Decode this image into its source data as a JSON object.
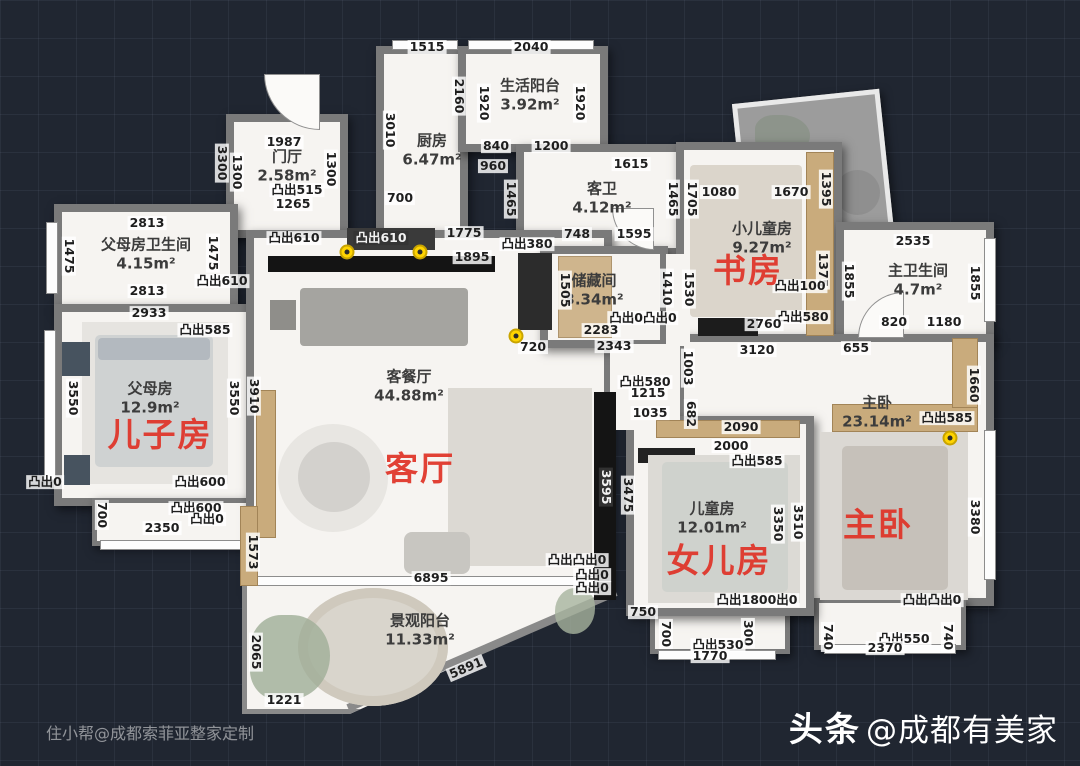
{
  "watermarks": {
    "bottom_left": "住小帮@成都索菲亚整家定制",
    "bottom_right_bold": "头条",
    "bottom_right_rest": "@成都有美家"
  },
  "colors": {
    "background": "#202631",
    "wall": "#7a7a7a",
    "floor": "#f6f4f1",
    "wood": "#c9ab7c",
    "red_label": "#e03226",
    "marker_yellow": "#ffd400"
  },
  "rooms": [
    {
      "name": "生活阳台",
      "area": "3.92m²",
      "x": 530,
      "y": 95
    },
    {
      "name": "厨房",
      "area": "6.47m²",
      "x": 432,
      "y": 150
    },
    {
      "name": "门厅",
      "area": "2.58m²",
      "x": 287,
      "y": 166
    },
    {
      "name": "客卫",
      "area": "4.12m²",
      "x": 602,
      "y": 198
    },
    {
      "name": "父母房卫生间",
      "area": "4.15m²",
      "x": 146,
      "y": 254
    },
    {
      "name": "小儿童房",
      "area": "9.27m²",
      "x": 762,
      "y": 238
    },
    {
      "name": "主卫生间",
      "area": "4.7m²",
      "x": 918,
      "y": 280
    },
    {
      "name": "储藏间",
      "area": "3.34m²",
      "x": 594,
      "y": 290
    },
    {
      "name": "父母房",
      "area": "12.9m²",
      "x": 150,
      "y": 398
    },
    {
      "name": "客餐厅",
      "area": "44.88m²",
      "x": 409,
      "y": 386
    },
    {
      "name": "主卧",
      "area": "23.14m²",
      "x": 877,
      "y": 412
    },
    {
      "name": "儿童房",
      "area": "12.01m²",
      "x": 712,
      "y": 518
    },
    {
      "name": "景观阳台",
      "area": "11.33m²",
      "x": 420,
      "y": 630
    }
  ],
  "red_labels": [
    {
      "text": "书房",
      "x": 748,
      "y": 268
    },
    {
      "text": "儿子房",
      "x": 160,
      "y": 432
    },
    {
      "text": "客厅",
      "x": 420,
      "y": 466
    },
    {
      "text": "女儿房",
      "x": 719,
      "y": 558
    },
    {
      "text": "主卧",
      "x": 878,
      "y": 522
    }
  ],
  "yellow_markers": [
    {
      "x": 347,
      "y": 252
    },
    {
      "x": 420,
      "y": 252
    },
    {
      "x": 516,
      "y": 336
    },
    {
      "x": 950,
      "y": 438
    }
  ],
  "dimensions": [
    {
      "t": "1515",
      "x": 427,
      "y": 47
    },
    {
      "t": "2040",
      "x": 531,
      "y": 47
    },
    {
      "t": "2160",
      "x": 459,
      "y": 96,
      "v": 1
    },
    {
      "t": "1920",
      "x": 484,
      "y": 103,
      "v": 1
    },
    {
      "t": "1920",
      "x": 580,
      "y": 103,
      "v": 1
    },
    {
      "t": "3010",
      "x": 390,
      "y": 130,
      "v": 1
    },
    {
      "t": "840",
      "x": 496,
      "y": 146
    },
    {
      "t": "1200",
      "x": 551,
      "y": 146
    },
    {
      "t": "960",
      "x": 493,
      "y": 166
    },
    {
      "t": "1465",
      "x": 511,
      "y": 199,
      "v": 1
    },
    {
      "t": "1465",
      "x": 673,
      "y": 199,
      "v": 1
    },
    {
      "t": "1615",
      "x": 631,
      "y": 164
    },
    {
      "t": "700",
      "x": 400,
      "y": 198
    },
    {
      "t": "1987",
      "x": 284,
      "y": 142
    },
    {
      "t": "1300",
      "x": 237,
      "y": 172,
      "v": 1
    },
    {
      "t": "1300",
      "x": 331,
      "y": 169,
      "v": 1
    },
    {
      "t": "3300",
      "x": 222,
      "y": 163,
      "v": 1
    },
    {
      "t": "凸出515",
      "x": 297,
      "y": 190
    },
    {
      "t": "1265",
      "x": 293,
      "y": 204
    },
    {
      "t": "凸出610",
      "x": 294,
      "y": 238
    },
    {
      "t": "凸出610",
      "x": 381,
      "y": 238,
      "dark": 1
    },
    {
      "t": "1775",
      "x": 464,
      "y": 233
    },
    {
      "t": "凸出380",
      "x": 527,
      "y": 244
    },
    {
      "t": "1895",
      "x": 472,
      "y": 257
    },
    {
      "t": "748",
      "x": 577,
      "y": 234
    },
    {
      "t": "1595",
      "x": 634,
      "y": 234
    },
    {
      "t": "1705",
      "x": 692,
      "y": 199,
      "v": 1
    },
    {
      "t": "1080",
      "x": 719,
      "y": 192
    },
    {
      "t": "1670",
      "x": 791,
      "y": 192
    },
    {
      "t": "1395",
      "x": 826,
      "y": 189,
      "v": 1
    },
    {
      "t": "2813",
      "x": 147,
      "y": 223
    },
    {
      "t": "1475",
      "x": 69,
      "y": 256,
      "v": 1
    },
    {
      "t": "1475",
      "x": 213,
      "y": 253,
      "v": 1
    },
    {
      "t": "凸出610",
      "x": 222,
      "y": 281
    },
    {
      "t": "2813",
      "x": 147,
      "y": 291
    },
    {
      "t": "2933",
      "x": 149,
      "y": 313
    },
    {
      "t": "凸出585",
      "x": 205,
      "y": 330
    },
    {
      "t": "2535",
      "x": 913,
      "y": 241
    },
    {
      "t": "1855",
      "x": 849,
      "y": 281,
      "v": 1
    },
    {
      "t": "1855",
      "x": 975,
      "y": 283,
      "v": 1
    },
    {
      "t": "820",
      "x": 894,
      "y": 322
    },
    {
      "t": "1180",
      "x": 944,
      "y": 322
    },
    {
      "t": "655",
      "x": 856,
      "y": 348
    },
    {
      "t": "3120",
      "x": 757,
      "y": 350
    },
    {
      "t": "2343",
      "x": 614,
      "y": 346
    },
    {
      "t": "720",
      "x": 533,
      "y": 347
    },
    {
      "t": "2283",
      "x": 601,
      "y": 330
    },
    {
      "t": "凸出0凸出0",
      "x": 643,
      "y": 318
    },
    {
      "t": "1505",
      "x": 565,
      "y": 290,
      "v": 1
    },
    {
      "t": "1410",
      "x": 667,
      "y": 288,
      "v": 1
    },
    {
      "t": "1530",
      "x": 689,
      "y": 289,
      "v": 1
    },
    {
      "t": "1375",
      "x": 823,
      "y": 270,
      "v": 1
    },
    {
      "t": "凸出100",
      "x": 800,
      "y": 286
    },
    {
      "t": "凸出580",
      "x": 803,
      "y": 317
    },
    {
      "t": "2760",
      "x": 764,
      "y": 324
    },
    {
      "t": "凸出580",
      "x": 645,
      "y": 382
    },
    {
      "t": "1215",
      "x": 648,
      "y": 393
    },
    {
      "t": "1003",
      "x": 688,
      "y": 368,
      "v": 1
    },
    {
      "t": "682",
      "x": 691,
      "y": 414,
      "v": 1
    },
    {
      "t": "1035",
      "x": 650,
      "y": 413
    },
    {
      "t": "2090",
      "x": 741,
      "y": 427
    },
    {
      "t": "2000",
      "x": 731,
      "y": 446
    },
    {
      "t": "凸出585",
      "x": 757,
      "y": 461
    },
    {
      "t": "3350",
      "x": 778,
      "y": 524,
      "v": 1
    },
    {
      "t": "3510",
      "x": 798,
      "y": 522,
      "v": 1
    },
    {
      "t": "3595",
      "x": 606,
      "y": 487,
      "v": 1,
      "dark": 1
    },
    {
      "t": "3475",
      "x": 628,
      "y": 495,
      "v": 1
    },
    {
      "t": "1660",
      "x": 974,
      "y": 385,
      "v": 1
    },
    {
      "t": "凸出585",
      "x": 947,
      "y": 418
    },
    {
      "t": "3380",
      "x": 975,
      "y": 517,
      "v": 1
    },
    {
      "t": "凸出凸出0",
      "x": 932,
      "y": 600
    },
    {
      "t": "740",
      "x": 828,
      "y": 637,
      "v": 1
    },
    {
      "t": "740",
      "x": 948,
      "y": 637,
      "v": 1
    },
    {
      "t": "凸出550",
      "x": 904,
      "y": 639
    },
    {
      "t": "2370",
      "x": 885,
      "y": 648
    },
    {
      "t": "凸出1800出0",
      "x": 757,
      "y": 600
    },
    {
      "t": "750",
      "x": 643,
      "y": 612
    },
    {
      "t": "700",
      "x": 666,
      "y": 634,
      "v": 1
    },
    {
      "t": "300",
      "x": 748,
      "y": 633,
      "v": 1
    },
    {
      "t": "凸出530",
      "x": 718,
      "y": 645
    },
    {
      "t": "1770",
      "x": 710,
      "y": 656
    },
    {
      "t": "凸出凸出0",
      "x": 577,
      "y": 560
    },
    {
      "t": "凸出0",
      "x": 592,
      "y": 575
    },
    {
      "t": "凸出0",
      "x": 592,
      "y": 588
    },
    {
      "t": "凸出0",
      "x": 45,
      "y": 482
    },
    {
      "t": "凸出600",
      "x": 200,
      "y": 482
    },
    {
      "t": "凸出600",
      "x": 196,
      "y": 508
    },
    {
      "t": "凸出0",
      "x": 207,
      "y": 519
    },
    {
      "t": "2350",
      "x": 162,
      "y": 528
    },
    {
      "t": "700",
      "x": 102,
      "y": 515,
      "v": 1
    },
    {
      "t": "3550",
      "x": 73,
      "y": 398,
      "v": 1
    },
    {
      "t": "3550",
      "x": 234,
      "y": 398,
      "v": 1
    },
    {
      "t": "3910",
      "x": 254,
      "y": 396,
      "v": 1
    },
    {
      "t": "1573",
      "x": 253,
      "y": 552,
      "v": 1
    },
    {
      "t": "2065",
      "x": 256,
      "y": 652,
      "v": 1
    },
    {
      "t": "1221",
      "x": 284,
      "y": 700
    },
    {
      "t": "6895",
      "x": 431,
      "y": 578
    },
    {
      "t": "5891",
      "x": 466,
      "y": 668,
      "rot": -23
    }
  ]
}
